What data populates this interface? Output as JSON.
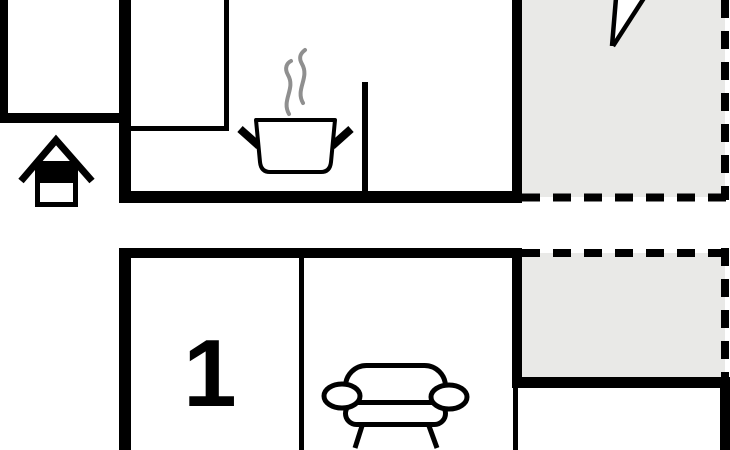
{
  "plan": {
    "room_1_label": "1"
  },
  "colors": {
    "wall": "#000000",
    "terrace": "#e9e9e7",
    "steam": "#8f8f8f",
    "background": "#ffffff"
  },
  "icons": {
    "house": "house-icon",
    "cooking_pot": "cooking-pot-icon",
    "steam": "steam-icon",
    "sofa": "sofa-icon",
    "entrance_arrow": "entrance-arrow-icon"
  }
}
